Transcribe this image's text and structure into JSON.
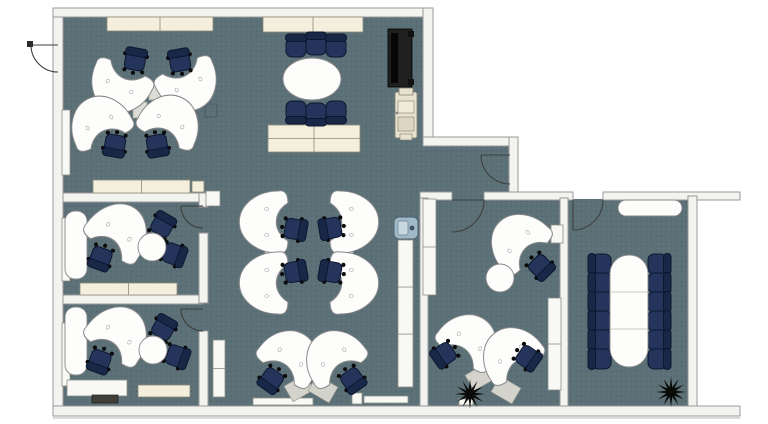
{
  "title": "Office floor plan",
  "colors": {
    "bg": "#ffffff",
    "floor": "#5b7177",
    "floorDark": "#33464c",
    "wall": "#f3f3f0",
    "wallStroke": "#98989b",
    "cream": "#f4efdc",
    "creamStroke": "#8f8b78",
    "casework": "#f8f8f4",
    "caseworkStroke": "#8f8f89",
    "desk": "#fdfdfb",
    "deskStroke": "#87878a",
    "connector": "#dcdcd5",
    "pad": "#d3d3cb",
    "chairSeat": "#25345a",
    "chairBack": "#1a2847",
    "chairStroke": "#0c1730",
    "caster": "#0a0a0a",
    "door": "#3f3f3f",
    "ghost": "#47585d",
    "tvBody": "#202020",
    "tvScreen": "#060606",
    "printerBody": "#e7e1cf",
    "printerStroke": "#827d6d",
    "printerInner": "#f0ead9",
    "coolerBody": "#9fb9c8",
    "coolerStroke": "#4e6170",
    "coolerInner": "#c9d8e0",
    "plant": "#0b0b09",
    "bench": "#413f3a",
    "shadow": "#cdcdc8"
  },
  "plan": {
    "width": 768,
    "height": 424,
    "floors": [
      {
        "x": 63,
        "y": 17,
        "w": 363,
        "h": 389
      },
      {
        "x": 420,
        "y": 146,
        "w": 90,
        "h": 54
      },
      {
        "x": 426,
        "y": 199,
        "w": 136,
        "h": 207
      },
      {
        "x": 566,
        "y": 199,
        "w": 124,
        "h": 207
      }
    ],
    "walls": [
      {
        "x": 53,
        "y": 8,
        "w": 10,
        "h": 408
      },
      {
        "x": 53,
        "y": 8,
        "w": 380,
        "h": 9
      },
      {
        "x": 423,
        "y": 8,
        "w": 10,
        "h": 136
      },
      {
        "x": 423,
        "y": 137,
        "w": 95,
        "h": 9
      },
      {
        "x": 509,
        "y": 137,
        "w": 9,
        "h": 57
      },
      {
        "x": 420,
        "y": 192,
        "w": 32,
        "h": 8
      },
      {
        "x": 484,
        "y": 192,
        "w": 89,
        "h": 8
      },
      {
        "x": 603,
        "y": 192,
        "w": 137,
        "h": 8
      },
      {
        "x": 688,
        "y": 196,
        "w": 9,
        "h": 214
      },
      {
        "x": 53,
        "y": 406,
        "w": 687,
        "h": 10
      },
      {
        "x": 420,
        "y": 198,
        "w": 8,
        "h": 208
      },
      {
        "x": 560,
        "y": 198,
        "w": 8,
        "h": 208
      },
      {
        "x": 63,
        "y": 193,
        "w": 140,
        "h": 9
      },
      {
        "x": 63,
        "y": 295,
        "w": 140,
        "h": 9
      },
      {
        "x": 199,
        "y": 193,
        "w": 9,
        "h": 14
      },
      {
        "x": 199,
        "y": 233,
        "w": 9,
        "h": 70
      },
      {
        "x": 199,
        "y": 331,
        "w": 9,
        "h": 75
      }
    ],
    "casework": [
      {
        "x": 107,
        "y": 17,
        "w": 106,
        "h": 14,
        "tone": "cream",
        "div": [
          0.5
        ]
      },
      {
        "x": 263,
        "y": 17,
        "w": 100,
        "h": 15,
        "tone": "cream",
        "div": [
          0.5
        ]
      },
      {
        "x": 268,
        "y": 125,
        "w": 92,
        "h": 27,
        "tone": "cream",
        "div": [
          0.5
        ],
        "hdiv": [
          0.5
        ]
      },
      {
        "x": 93,
        "y": 180,
        "w": 97,
        "h": 13,
        "tone": "cream",
        "div": [
          0.5
        ]
      },
      {
        "x": 192,
        "y": 181,
        "w": 12,
        "h": 11,
        "tone": "cream"
      },
      {
        "x": 80,
        "y": 283,
        "w": 97,
        "h": 12,
        "tone": "cream",
        "div": [
          0.5
        ]
      },
      {
        "x": 138,
        "y": 385,
        "w": 52,
        "h": 12,
        "tone": "cream"
      },
      {
        "x": 62,
        "y": 110,
        "w": 8,
        "h": 65,
        "tone": "white"
      },
      {
        "x": 62,
        "y": 218,
        "w": 8,
        "h": 63,
        "tone": "white"
      },
      {
        "x": 62,
        "y": 323,
        "w": 8,
        "h": 63,
        "tone": "white"
      },
      {
        "x": 213,
        "y": 340,
        "w": 12,
        "h": 57,
        "tone": "white",
        "hdiv": [
          0.5
        ]
      },
      {
        "x": 398,
        "y": 240,
        "w": 15,
        "h": 147,
        "tone": "white",
        "hdiv": [
          0.32,
          0.64
        ]
      },
      {
        "x": 423,
        "y": 199,
        "w": 13,
        "h": 96,
        "tone": "white",
        "hdiv": [
          0.5
        ]
      },
      {
        "x": 551,
        "y": 225,
        "w": 12,
        "h": 18,
        "tone": "white"
      },
      {
        "x": 548,
        "y": 298,
        "w": 13,
        "h": 92,
        "tone": "white",
        "hdiv": [
          0.5
        ]
      },
      {
        "x": 253,
        "y": 398,
        "w": 60,
        "h": 7,
        "tone": "white"
      },
      {
        "x": 364,
        "y": 396,
        "w": 44,
        "h": 7,
        "tone": "white"
      },
      {
        "x": 352,
        "y": 393,
        "w": 10,
        "h": 11,
        "tone": "white"
      },
      {
        "x": 67,
        "y": 380,
        "w": 60,
        "h": 16,
        "tone": "white"
      },
      {
        "x": 206,
        "y": 191,
        "w": 14,
        "h": 15,
        "tone": "white"
      },
      {
        "x": 459,
        "y": 399,
        "w": 14,
        "h": 6,
        "tone": "white"
      },
      {
        "x": 340,
        "y": 342,
        "w": 12,
        "h": 14,
        "tone": "ghost"
      },
      {
        "x": 205,
        "y": 104,
        "w": 12,
        "h": 13,
        "tone": "ghost"
      }
    ],
    "doors": [
      {
        "d": "M 31,45 L 58,45"
      },
      {
        "d": "M 31,45 A 27 27 0 0 0 58,72"
      },
      {
        "d": "M 181,206 L 203,206"
      },
      {
        "d": "M 181,206 A 22 22 0 0 0 203,228"
      },
      {
        "d": "M 181,309 L 203,309"
      },
      {
        "d": "M 181,309 A 22 22 0 0 0 203,331"
      },
      {
        "d": "M 481,155 L 510,155"
      },
      {
        "d": "M 481,155 A 29 29 0 0 0 510,184"
      },
      {
        "d": "M 452,200 L 484,200"
      },
      {
        "d": "M 484,200 A 32 32 0 0 1 452,232"
      },
      {
        "d": "M 573,200 L 573,230"
      },
      {
        "d": "M 603,200 A 30 30 0 0 1 573,230"
      }
    ],
    "hinges": [
      {
        "x": 27,
        "y": 41,
        "w": 6,
        "h": 6
      }
    ],
    "furniture": [
      {
        "sym": "connector",
        "x": 156,
        "y": 92
      },
      {
        "sym": "connector",
        "x": 140,
        "y": 110
      },
      {
        "sym": "bean",
        "x": 122,
        "y": 81,
        "r": 25,
        "sy": 1.2
      },
      {
        "sym": "bean",
        "x": 186,
        "y": 79,
        "r": -25,
        "sy": 1.2
      },
      {
        "sym": "bean",
        "x": 102,
        "y": 128,
        "r": 155,
        "sy": 1.2
      },
      {
        "sym": "bean",
        "x": 168,
        "y": 127,
        "r": 205,
        "sy": 1.2
      },
      {
        "sym": "chair",
        "x": 135,
        "y": 61,
        "r": 10
      },
      {
        "sym": "chair",
        "x": 180,
        "y": 62,
        "r": -10
      },
      {
        "sym": "chair",
        "x": 115,
        "y": 144,
        "r": 190
      },
      {
        "sym": "chair",
        "x": 157,
        "y": 144,
        "r": 170
      },
      {
        "sym": "chair2",
        "x": 296,
        "y": 47,
        "r": 0
      },
      {
        "sym": "chair2",
        "x": 316,
        "y": 45,
        "r": 0
      },
      {
        "sym": "chair2",
        "x": 336,
        "y": 47,
        "r": 0
      },
      {
        "sym": "chair2",
        "x": 296,
        "y": 111,
        "r": 180
      },
      {
        "sym": "chair2",
        "x": 316,
        "y": 113,
        "r": 180
      },
      {
        "sym": "chair2",
        "x": 336,
        "y": 111,
        "r": 180
      },
      {
        "sym": "table-oval",
        "x": 312,
        "y": 79
      },
      {
        "sym": "tv",
        "x": 400,
        "y": 58
      },
      {
        "sym": "printer",
        "x": 406,
        "y": 115
      },
      {
        "sym": "connector",
        "x": 273,
        "y": 252,
        "r": 90
      },
      {
        "sym": "connector",
        "x": 345,
        "y": 252,
        "r": 90
      },
      {
        "sym": "bean",
        "x": 273,
        "y": 222,
        "r": 90,
        "sy": 1.25
      },
      {
        "sym": "bean",
        "x": 273,
        "y": 283,
        "r": 90,
        "sy": 1.25
      },
      {
        "sym": "bean",
        "x": 345,
        "y": 222,
        "r": -90,
        "sy": 1.25
      },
      {
        "sym": "bean",
        "x": 345,
        "y": 283,
        "r": -90,
        "sy": 1.25
      },
      {
        "sym": "chair",
        "x": 294,
        "y": 229,
        "r": 100
      },
      {
        "sym": "chair",
        "x": 294,
        "y": 272,
        "r": 80
      },
      {
        "sym": "chair",
        "x": 332,
        "y": 228,
        "r": -100
      },
      {
        "sym": "chair",
        "x": 332,
        "y": 272,
        "r": -80
      },
      {
        "sym": "cooler",
        "x": 406,
        "y": 228
      },
      {
        "sym": "deskpad",
        "x": 299,
        "y": 388,
        "r": -30
      },
      {
        "sym": "deskpad",
        "x": 323,
        "y": 389,
        "r": 30
      },
      {
        "sym": "bean",
        "x": 287,
        "y": 362,
        "r": 215,
        "sy": 1.2
      },
      {
        "sym": "bean",
        "x": 337,
        "y": 362,
        "r": 145,
        "sy": 1.2
      },
      {
        "sym": "chair",
        "x": 272,
        "y": 379,
        "r": 215
      },
      {
        "sym": "chair",
        "x": 352,
        "y": 379,
        "r": 145
      },
      {
        "sym": "slab",
        "x": 76,
        "y": 245
      },
      {
        "sym": "bean",
        "x": 115,
        "y": 237,
        "r": 215,
        "sy": 1.3
      },
      {
        "sym": "chair",
        "x": 101,
        "y": 257,
        "r": 200
      },
      {
        "sym": "chair",
        "x": 162,
        "y": 226,
        "r": 30
      },
      {
        "sym": "chair",
        "x": 173,
        "y": 254,
        "r": 110
      },
      {
        "sym": "table-round",
        "x": 152,
        "y": 247
      },
      {
        "sym": "slab",
        "x": 76,
        "y": 341
      },
      {
        "sym": "bean",
        "x": 115,
        "y": 340,
        "r": 215,
        "sy": 1.3
      },
      {
        "sym": "chair",
        "x": 100,
        "y": 360,
        "r": 200
      },
      {
        "sym": "chair",
        "x": 163,
        "y": 329,
        "r": 30
      },
      {
        "sym": "chair",
        "x": 176,
        "y": 356,
        "r": 110
      },
      {
        "sym": "table-round",
        "x": 153,
        "y": 350
      },
      {
        "sym": "bench",
        "x": 105,
        "y": 399
      },
      {
        "sym": "bean",
        "x": 523,
        "y": 246,
        "r": 135,
        "sy": 1.25
      },
      {
        "sym": "table-round",
        "x": 500,
        "y": 278
      },
      {
        "sym": "chair",
        "x": 540,
        "y": 266,
        "r": 135
      },
      {
        "sym": "deskpad",
        "x": 480,
        "y": 377,
        "r": -30
      },
      {
        "sym": "deskpad",
        "x": 506,
        "y": 390,
        "r": 30
      },
      {
        "sym": "bean",
        "x": 466,
        "y": 346,
        "r": 215,
        "sy": 1.2
      },
      {
        "sym": "bean",
        "x": 514,
        "y": 359,
        "r": 145,
        "sy": 1.2
      },
      {
        "sym": "chair",
        "x": 445,
        "y": 354,
        "r": 235
      },
      {
        "sym": "chair",
        "x": 527,
        "y": 357,
        "r": 125
      },
      {
        "sym": "plant",
        "x": 470,
        "y": 394
      },
      {
        "sym": "pill",
        "x": 650,
        "y": 208
      },
      {
        "sym": "chair2",
        "x": 601,
        "y": 264,
        "r": -90
      },
      {
        "sym": "chair2",
        "x": 601,
        "y": 283,
        "r": -90
      },
      {
        "sym": "chair2",
        "x": 601,
        "y": 302,
        "r": -90
      },
      {
        "sym": "chair2",
        "x": 601,
        "y": 321,
        "r": -90
      },
      {
        "sym": "chair2",
        "x": 601,
        "y": 340,
        "r": -90
      },
      {
        "sym": "chair2",
        "x": 601,
        "y": 359,
        "r": -90
      },
      {
        "sym": "chair2",
        "x": 658,
        "y": 264,
        "r": 90
      },
      {
        "sym": "chair2",
        "x": 658,
        "y": 283,
        "r": 90
      },
      {
        "sym": "chair2",
        "x": 658,
        "y": 302,
        "r": 90
      },
      {
        "sym": "chair2",
        "x": 658,
        "y": 321,
        "r": 90
      },
      {
        "sym": "chair2",
        "x": 658,
        "y": 340,
        "r": 90
      },
      {
        "sym": "chair2",
        "x": 658,
        "y": 359,
        "r": 90
      },
      {
        "sym": "table-conf",
        "x": 629,
        "y": 311
      },
      {
        "sym": "plant",
        "x": 671,
        "y": 392
      }
    ],
    "lines": [
      {
        "x1": 53,
        "y1": 418,
        "x2": 740,
        "y2": 418
      }
    ]
  }
}
